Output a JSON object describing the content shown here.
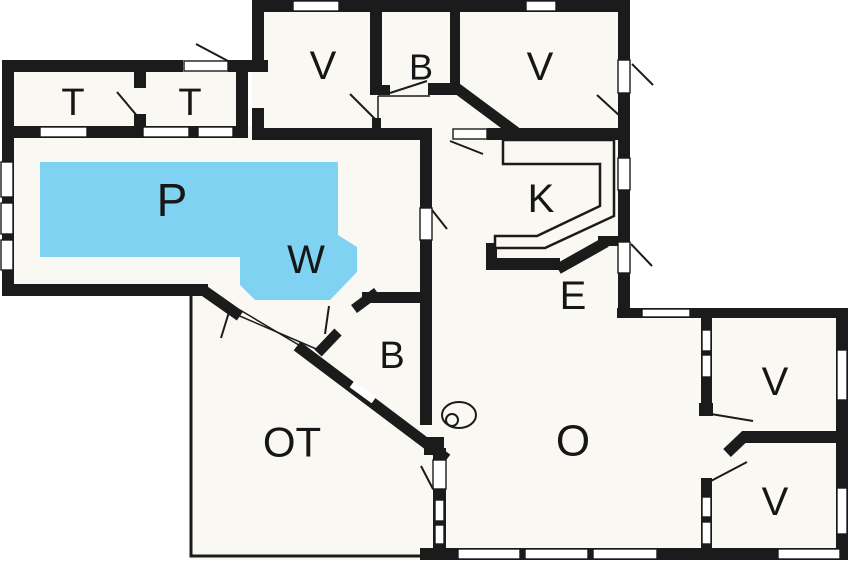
{
  "plan": {
    "title": "Summer house floor plan",
    "colors": {
      "wall": "#1b1b1b",
      "floor": "#faf8f2",
      "outside": "#ffffff",
      "pool": "#7fd2f2",
      "thin_line": "#1b1b1b"
    },
    "pool": {
      "points": "40,162 338,162 338,235 357,247 357,272 330,300 255,300 240,285 240,257 40,257",
      "labels": {
        "pool": "P",
        "whirlpool": "W"
      }
    },
    "stove": {
      "cx": 459,
      "cy": 415,
      "rx": 17,
      "ry": 13,
      "inner_cx": 452,
      "inner_cy": 420,
      "inner_r": 6
    },
    "rooms": [
      {
        "id": "toilet-1",
        "label": "T",
        "x": 73,
        "y": 103,
        "size": 38
      },
      {
        "id": "toilet-2",
        "label": "T",
        "x": 190,
        "y": 103,
        "size": 38
      },
      {
        "id": "bedroom-top-middle",
        "label": "V",
        "x": 323,
        "y": 66,
        "size": 40
      },
      {
        "id": "bath-top",
        "label": "B",
        "x": 421,
        "y": 67,
        "size": 36
      },
      {
        "id": "bedroom-top-right",
        "label": "V",
        "x": 540,
        "y": 67,
        "size": 40
      },
      {
        "id": "pool",
        "label": "P",
        "x": 172,
        "y": 200,
        "size": 46
      },
      {
        "id": "whirlpool",
        "label": "W",
        "x": 306,
        "y": 260,
        "size": 40
      },
      {
        "id": "kitchen",
        "label": "K",
        "x": 541,
        "y": 199,
        "size": 40
      },
      {
        "id": "entry",
        "label": "E",
        "x": 573,
        "y": 296,
        "size": 40
      },
      {
        "id": "bath-middle",
        "label": "B",
        "x": 392,
        "y": 356,
        "size": 38
      },
      {
        "id": "covered-terrace",
        "label": "OT",
        "x": 292,
        "y": 442,
        "size": 42
      },
      {
        "id": "living-room",
        "label": "O",
        "x": 573,
        "y": 441,
        "size": 44
      },
      {
        "id": "bedroom-right-top",
        "label": "V",
        "x": 775,
        "y": 382,
        "size": 40
      },
      {
        "id": "bedroom-right-bottom",
        "label": "V",
        "x": 775,
        "y": 502,
        "size": 40
      }
    ]
  }
}
